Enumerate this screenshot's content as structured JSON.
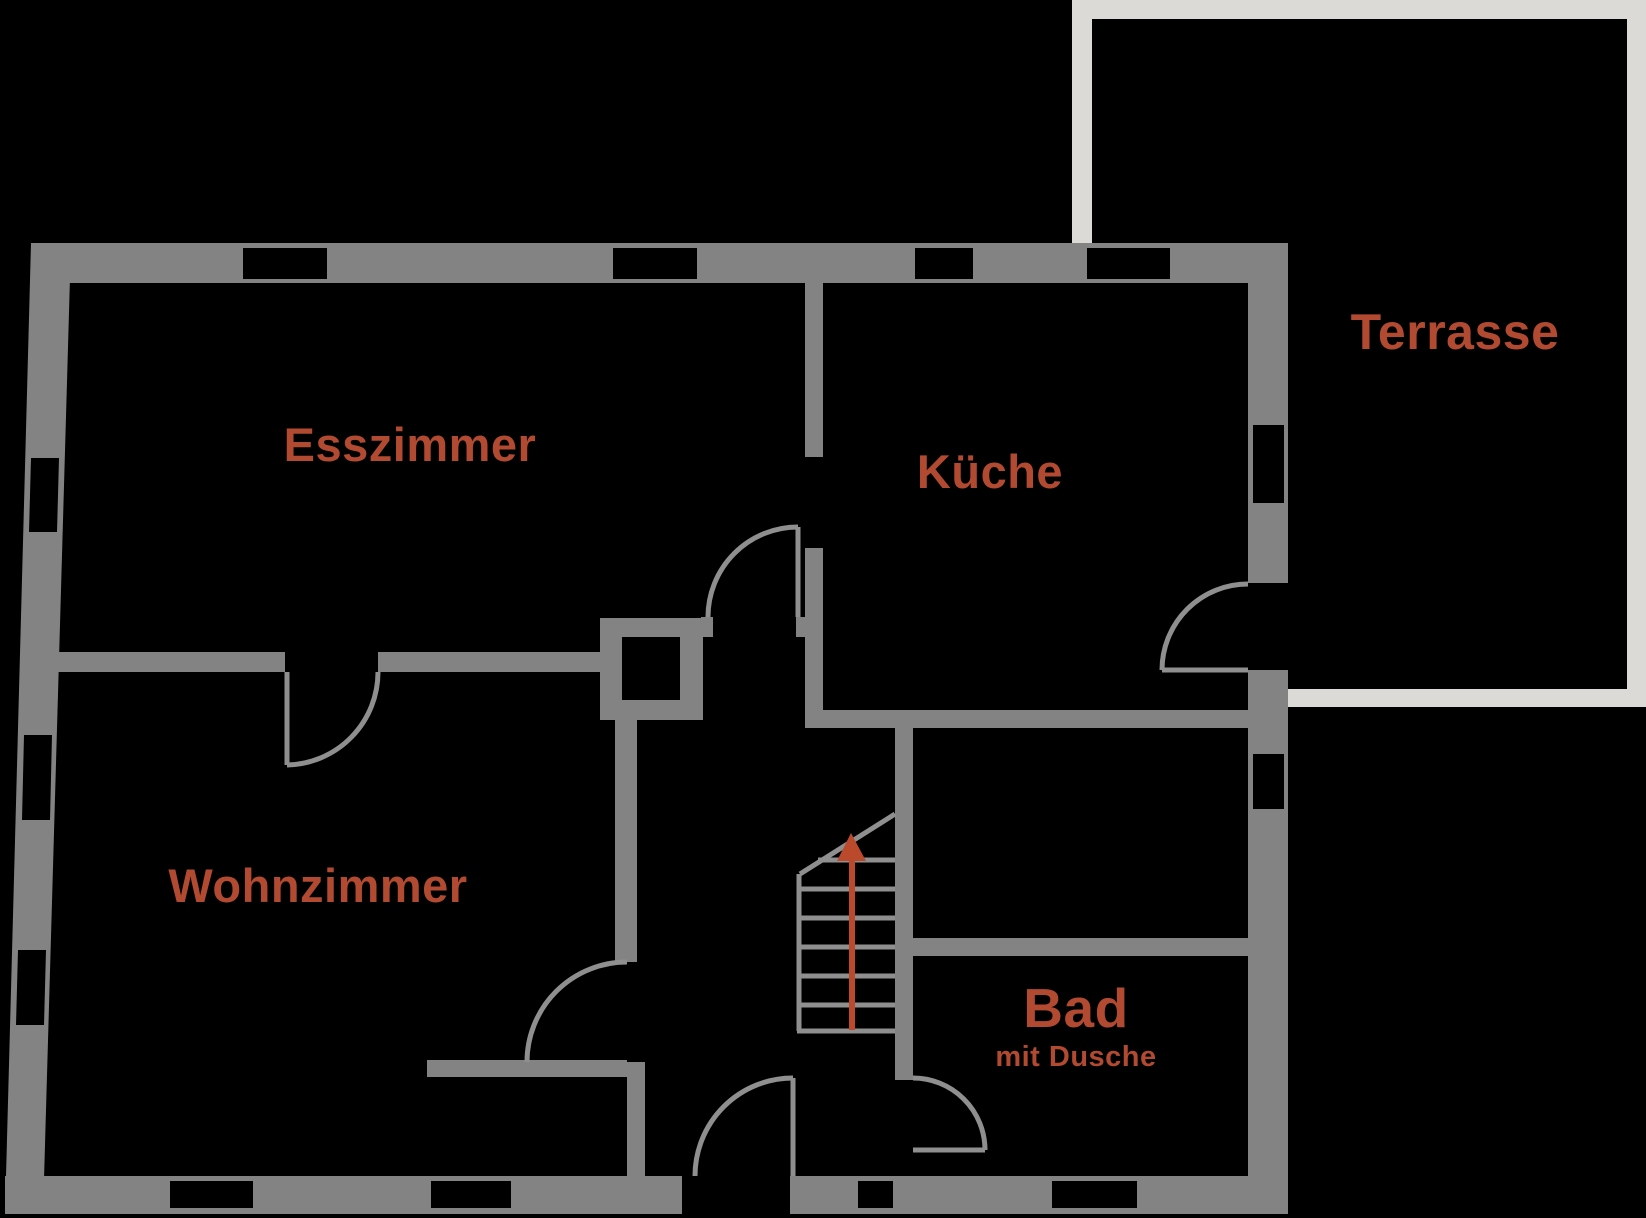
{
  "plan": {
    "type": "floor-plan",
    "floor_labels": {
      "esszimmer": "Esszimmer",
      "kueche": "Küche",
      "terrasse": "Terrasse",
      "wohnzimmer": "Wohnzimmer",
      "bad": "Bad",
      "bad_sub": "mit Dusche"
    },
    "icons": {
      "stairs_direction": "stairs-up-arrow-icon"
    },
    "colors": {
      "background": "#000000",
      "wall": "#838383",
      "terrace": "#dbdad7",
      "door_line": "#8f8f8f",
      "stair_line": "#8f8f8f",
      "accent": "#b14a30",
      "arrow": "#ba4a2b"
    }
  }
}
